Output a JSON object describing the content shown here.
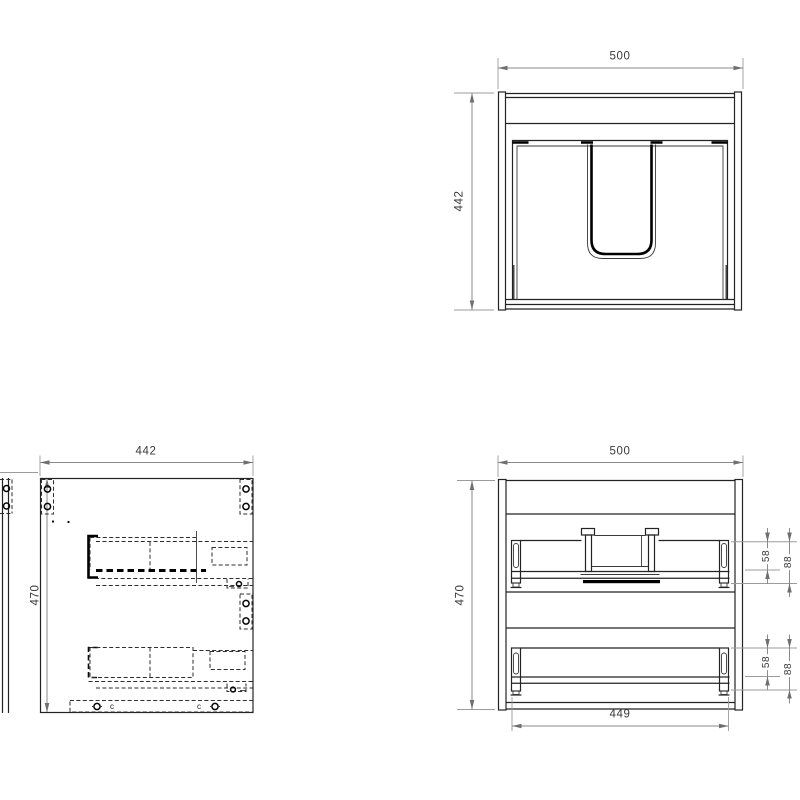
{
  "views": {
    "top": {
      "width_dim": "500",
      "depth_dim": "442"
    },
    "side": {
      "width_dim": "442",
      "height_dim": "470",
      "screw_marker_left": "c",
      "screw_marker_right": "c"
    },
    "front": {
      "width_dim": "500",
      "height_dim": "470",
      "inner_width_dim": "449",
      "upper_drawer": {
        "rail_offset_dim": "58",
        "slide_offset_dim": "88"
      },
      "lower_drawer": {
        "rail_offset_dim": "58",
        "slide_offset_dim": "88"
      }
    }
  },
  "colors": {
    "background": "#ffffff",
    "drawing_line": "#232323",
    "bold_line": "#000000",
    "hidden_line": "#2d2d2d",
    "dimension_line": "#8a8a8a",
    "dimension_text": "#3a3a3a"
  }
}
